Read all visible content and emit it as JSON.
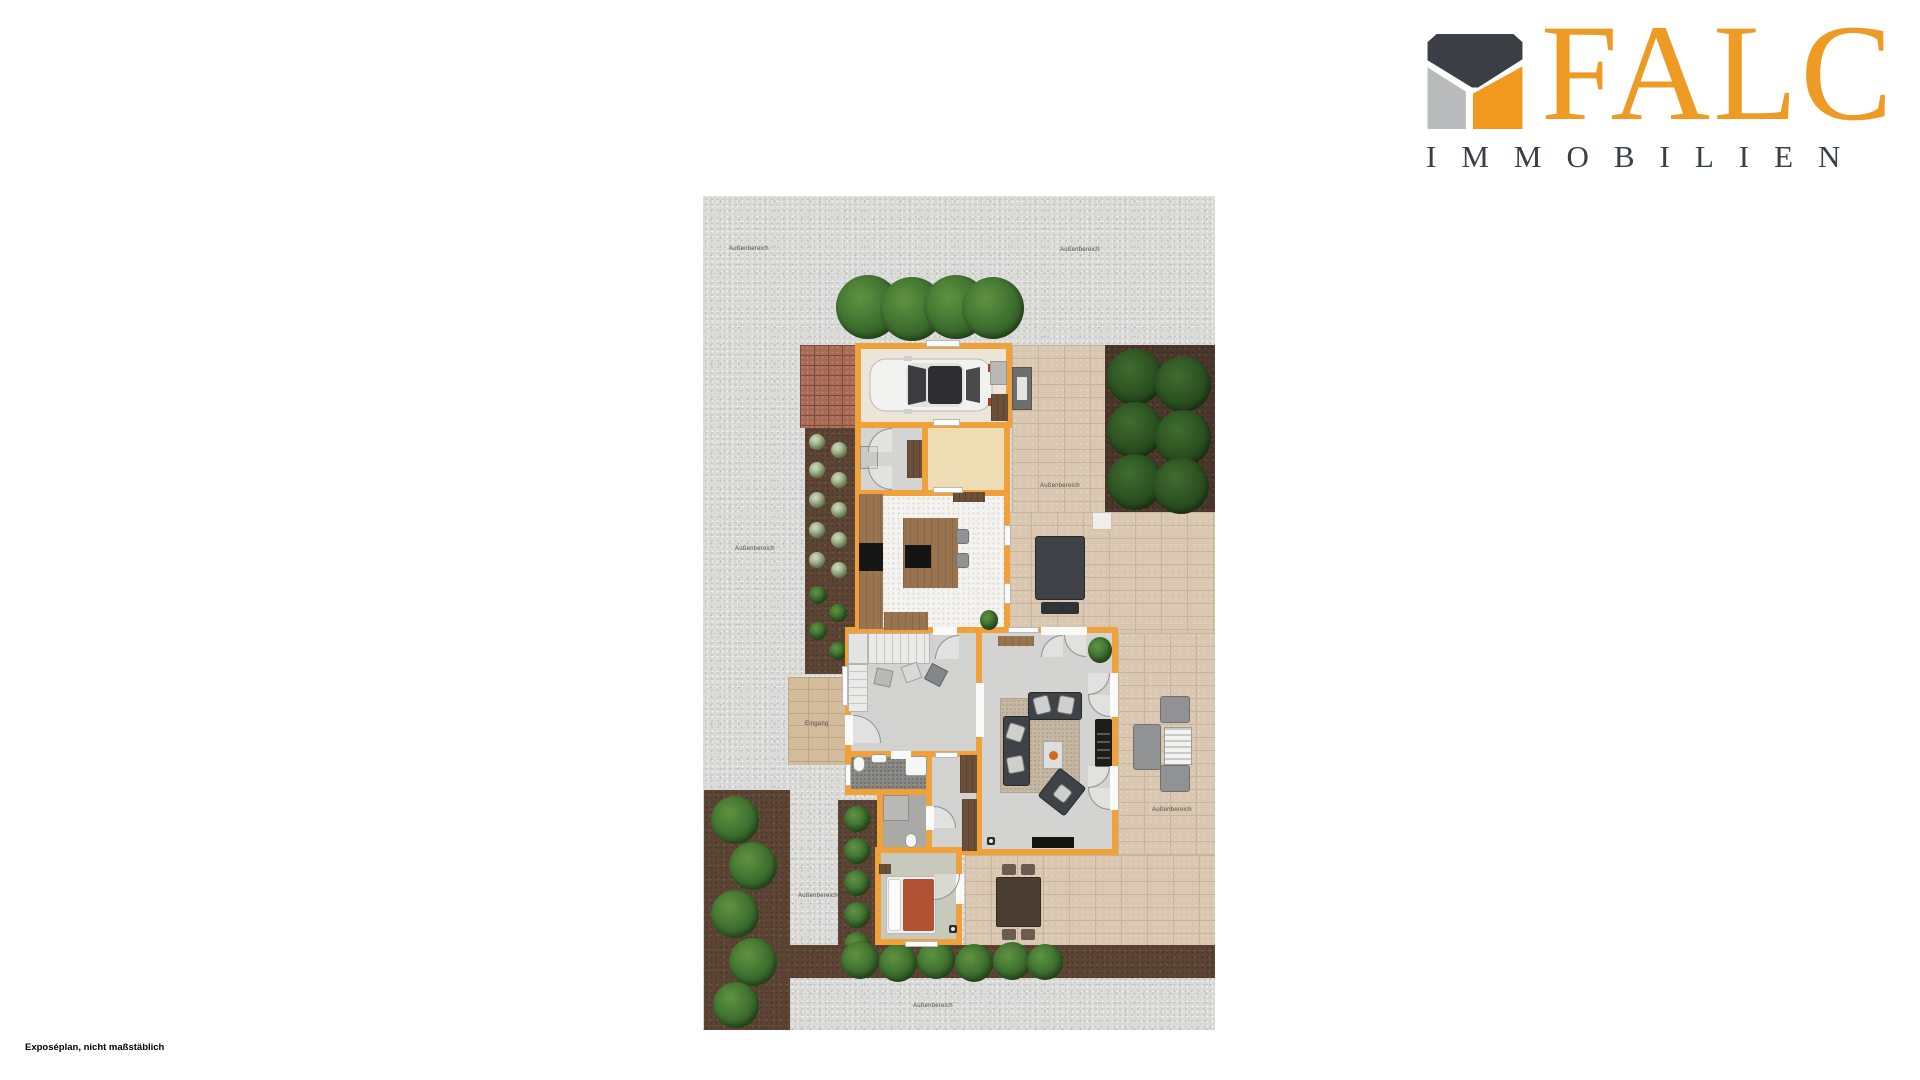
{
  "logo": {
    "name": "FALC",
    "subtitle": "IMMOBILIEN",
    "colors": {
      "orange": "#EE9B26",
      "dark": "#3A3E46",
      "gray": "#B9BABC"
    }
  },
  "plan": {
    "outdoor_label": "Außenbereich",
    "entrance_label": "Eingang",
    "wall_color": "#F1A13A"
  },
  "footer": {
    "note": "Exposéplan, nicht maßstäblich"
  }
}
